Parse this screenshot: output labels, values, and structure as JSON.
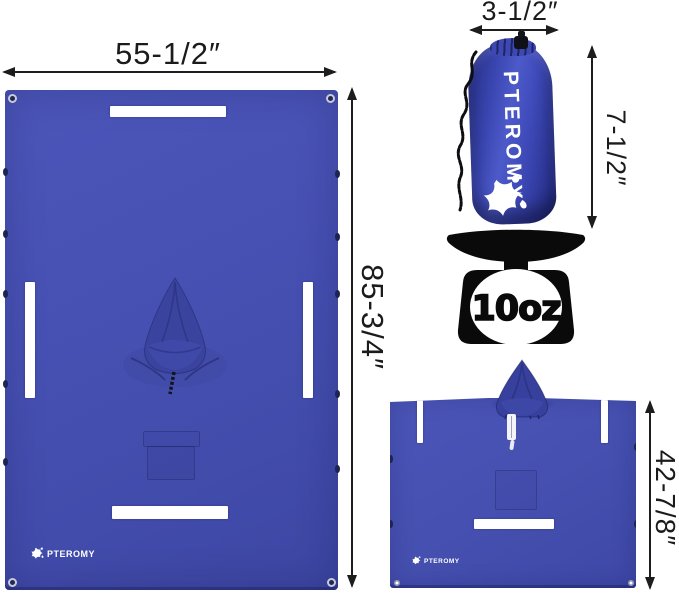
{
  "product": {
    "brand": "PTEROMY"
  },
  "annotations": {
    "flat_width": "55-1/2″",
    "flat_length": "85-3/4″",
    "pouch_width": "3-1/2″",
    "pouch_height": "7-1/2″",
    "worn_length": "42-7/8″",
    "weight": "10oz"
  },
  "icons": {
    "weight_scale": "kitchen-scale-icon",
    "brand_logo": "star-figure-icon",
    "hood": "hood-icon",
    "grommet": "grommet-icon",
    "drawstring": "drawstring-cord-icon",
    "reflective_strip": "reflective-strip"
  },
  "colors": {
    "poncho_blue": "#4751b3",
    "hood_blue": "#3a439e",
    "pouch_blue": "#3c48b6",
    "reflective_strip": "#ffffff",
    "annotation": "#1b1b1b",
    "scale_black": "#0a0a0a"
  }
}
